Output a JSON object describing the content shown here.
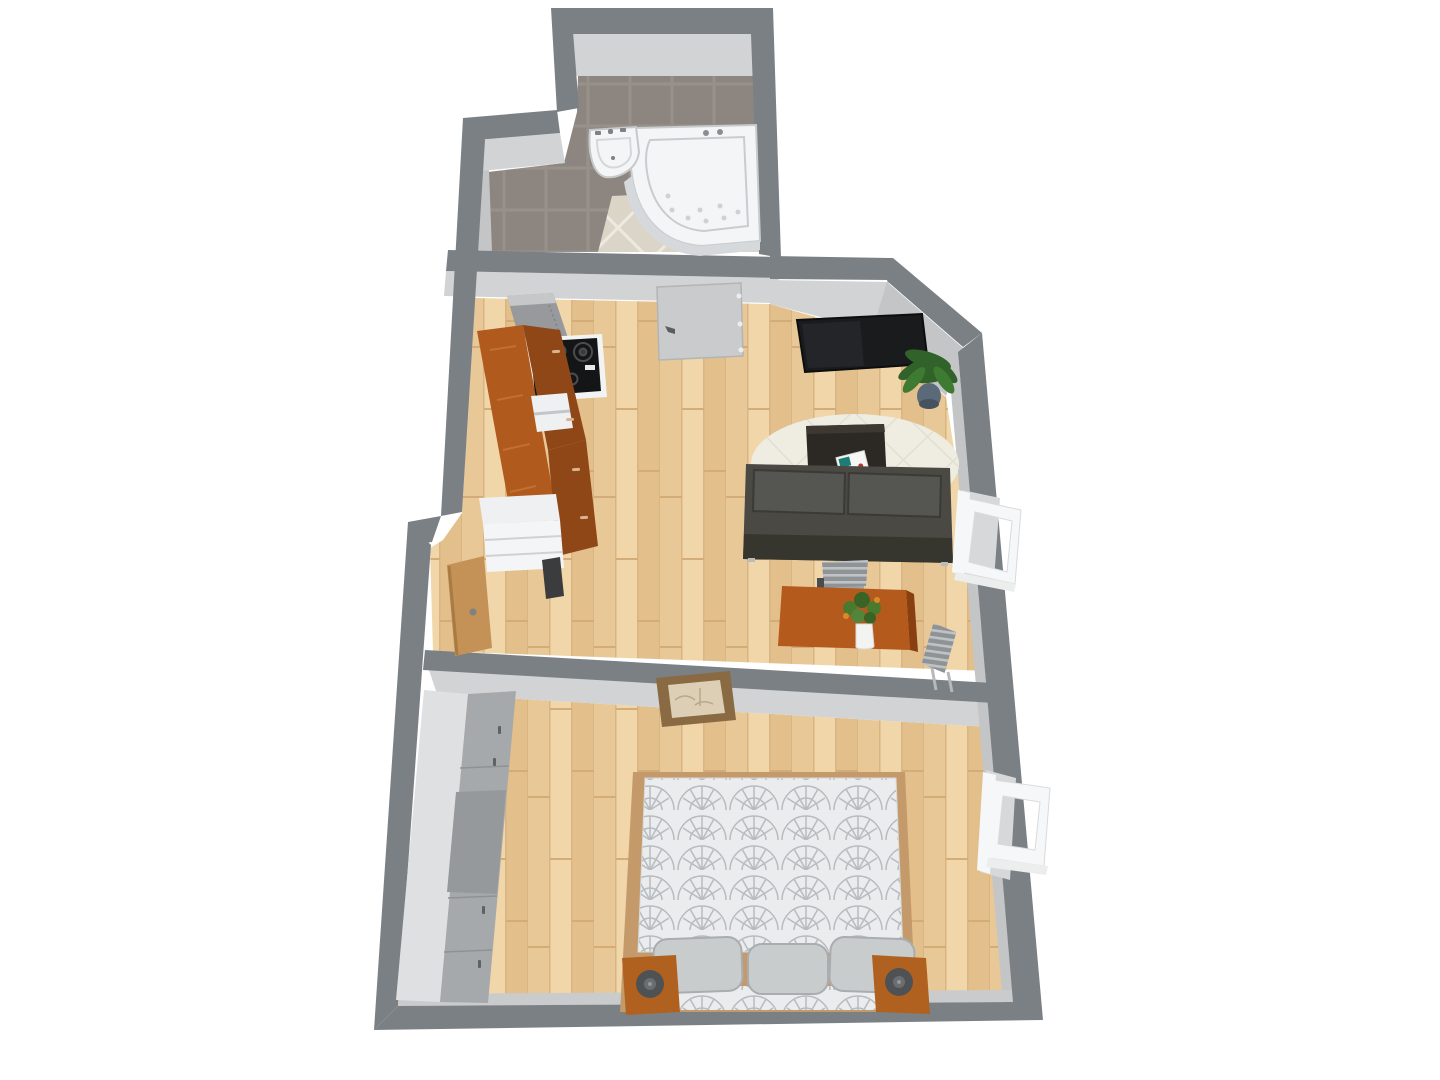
{
  "meta": {
    "title": "3D top-down floor plan of a one-bedroom apartment",
    "view": "3d-dollhouse-top-view",
    "canvas": {
      "width": 1440,
      "height": 1080
    }
  },
  "rooms": [
    {
      "id": "bathroom",
      "name": "bathroom",
      "floor": "dark ceramic tile with light diagonal tile inset",
      "furniture": [
        "corner-bathtub",
        "wall-sink"
      ]
    },
    {
      "id": "kitchen-living",
      "name": "kitchen / living room",
      "floor": "light wood plank",
      "furniture": [
        "refrigerator",
        "range-cooktop",
        "kitchen-cabinet-run",
        "open-shelf-niche",
        "counter-appliance",
        "oven-slot",
        "entry-door-open",
        "interior-door",
        "wall-tv",
        "potted-plant",
        "area-rug",
        "coffee-table",
        "magazine",
        "sofa",
        "dining-chair-back",
        "dining-chair-right",
        "dining-table",
        "flower-vase",
        "casement-window-open"
      ]
    },
    {
      "id": "bedroom",
      "name": "bedroom",
      "floor": "light wood plank",
      "furniture": [
        "wall-picture",
        "wardrobe-run",
        "double-bed",
        "pillow",
        "pillow",
        "pillow",
        "nightstand-left",
        "nightstand-right",
        "table-lamp",
        "table-lamp",
        "casement-window-open"
      ]
    }
  ],
  "counts": {
    "windows_open": 2,
    "interior_doors": 2,
    "rooms": 3
  },
  "colors": {
    "bg": "#ffffff",
    "wall": "#7b8085",
    "wallFace": "#d2d3d5",
    "wallFaceDim": "#c3c5c7",
    "tileGrout": "#989189",
    "tileDark": "#8d8680",
    "tileLightGrout": "#eee9e0",
    "tileLight": "#dbd5c8",
    "woodA": "#e9c897",
    "woodB": "#f0d6a9",
    "woodC": "#e3bf8c",
    "woodSeam": "#d8b582",
    "fixtureWhite": "#f4f5f6",
    "fixtureShade": "#c9ccce",
    "fridge": "#97999c",
    "fridgeTop": "#c5c7c9",
    "applianceWhite": "#f2f3f3",
    "cooktop": "#141517",
    "cabinetTop": "#b05a1e",
    "cabinetFront": "#8f4717",
    "nicheWhite": "#eef0f1",
    "ovenDark": "#3a3c3e",
    "doorGray": "#c9cbcd",
    "doorWood": "#c49257",
    "tv": "#191b1d",
    "plantGreen": "#31622a",
    "plantPot": "#5a6a78",
    "rug": "#efece2",
    "rugLine": "#e2dfd2",
    "coffeeTable": "#2c2824",
    "sofa": "#4a4943",
    "sofaCushion": "#555551",
    "sofaFront": "#37362e",
    "chairGray": "#8f9396",
    "chairStripe": "#c0c3c5",
    "diningTable": "#b55a1d",
    "diningTableEdge": "#8a3f10",
    "windowWhite": "#f6f7f8",
    "windowGap": "#d7d8da",
    "pictureFrame": "#8a6a42",
    "pictureInner": "#dccfb5",
    "wardrobeTop": "#dfe0e2",
    "wardrobeFront": "#a6a9ab",
    "wardrobeMirror": "#95999c",
    "bedFrame": "#c49a6a",
    "duvetBase": "#ebeced",
    "duvetPattern": "#b7bcbf",
    "pillow": "#c9cccd",
    "nightstand": "#b0611f",
    "lamp": "#4e5255",
    "vaseWhite": "#f3f4f2",
    "flowerOrange": "#d98a2b",
    "magazineTeal": "#1d7d74"
  }
}
